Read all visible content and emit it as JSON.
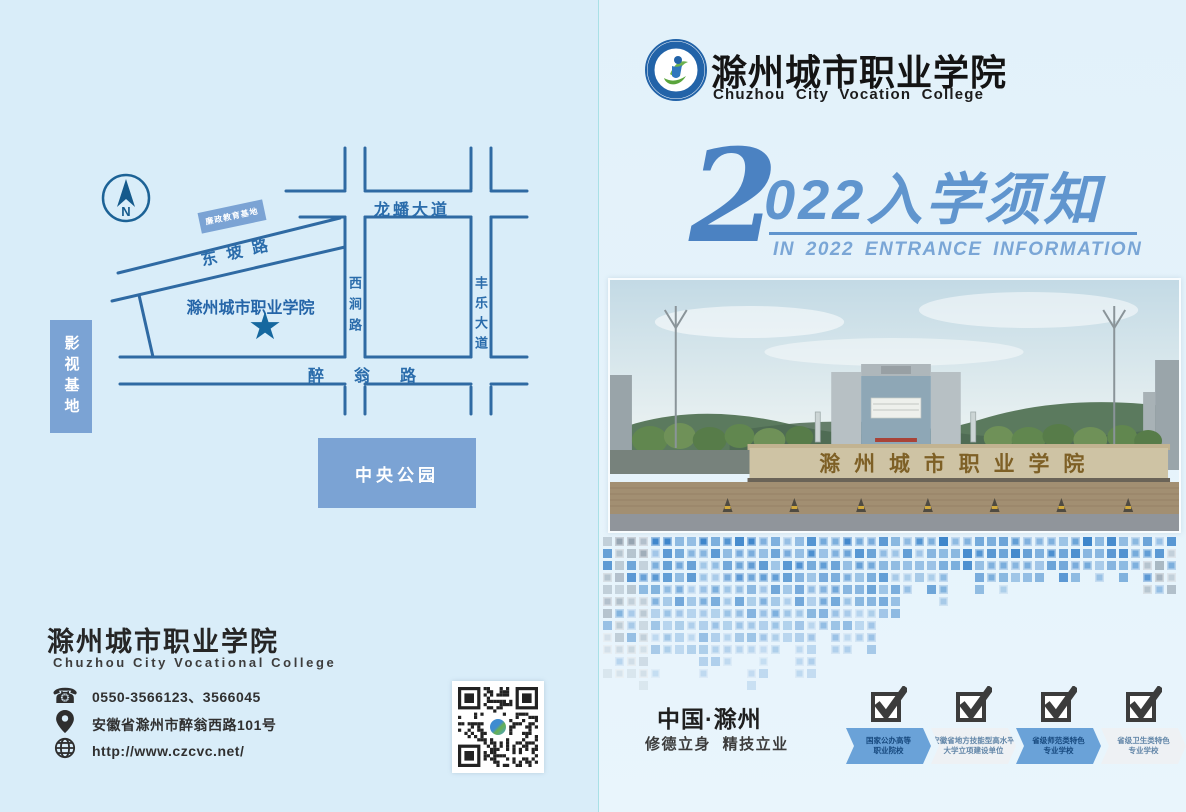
{
  "colors": {
    "accent_blue": "#6095ce",
    "road_blue": "#2f6aa3",
    "map_box_blue": "#7ba3d4",
    "banner_blue": "#6aa2d8",
    "dark_text": "#262626"
  },
  "map": {
    "compass": "N",
    "roads": {
      "longpan": "龙蟠大道",
      "dongpo": "东坡路",
      "xijian": "西涧路",
      "fengle": "丰乐大道",
      "zuiweng": "醉翁路"
    },
    "places": {
      "lianzheng": "廉政教育基地",
      "yingshi": "影视基地",
      "central_park": "中央公园",
      "college": "滁州城市职业学院",
      "college_marker": "★"
    }
  },
  "left_footer": {
    "college_cn": "滁州城市职业学院",
    "college_en": "Chuzhou City Vocational College",
    "phone": "0550-3566123、3566045",
    "address": "安徽省滁州市醉翁西路101号",
    "website": "http://www.czcvc.net/"
  },
  "header": {
    "college_cn": "滁州城市职业学院",
    "college_en": "Chuzhou City Vocation College"
  },
  "title": {
    "big_digit": "2",
    "rest": "022入学须知",
    "subtitle": "IN 2022 ENTRANCE INFORMATION"
  },
  "photo": {
    "gate_text": "滁州城市职业学院"
  },
  "footer_right": {
    "location": "中国·滁州",
    "slogan": "修德立身 精技立业",
    "badges": [
      {
        "line1": "国家公办高等",
        "line2": "职业院校"
      },
      {
        "line1": "安徽省地方技能型高水平",
        "line2": "大学立项建设单位"
      },
      {
        "line1": "省级师范类特色",
        "line2": "专业学校"
      },
      {
        "line1": "省级卫生类特色",
        "line2": "专业学校"
      }
    ]
  }
}
